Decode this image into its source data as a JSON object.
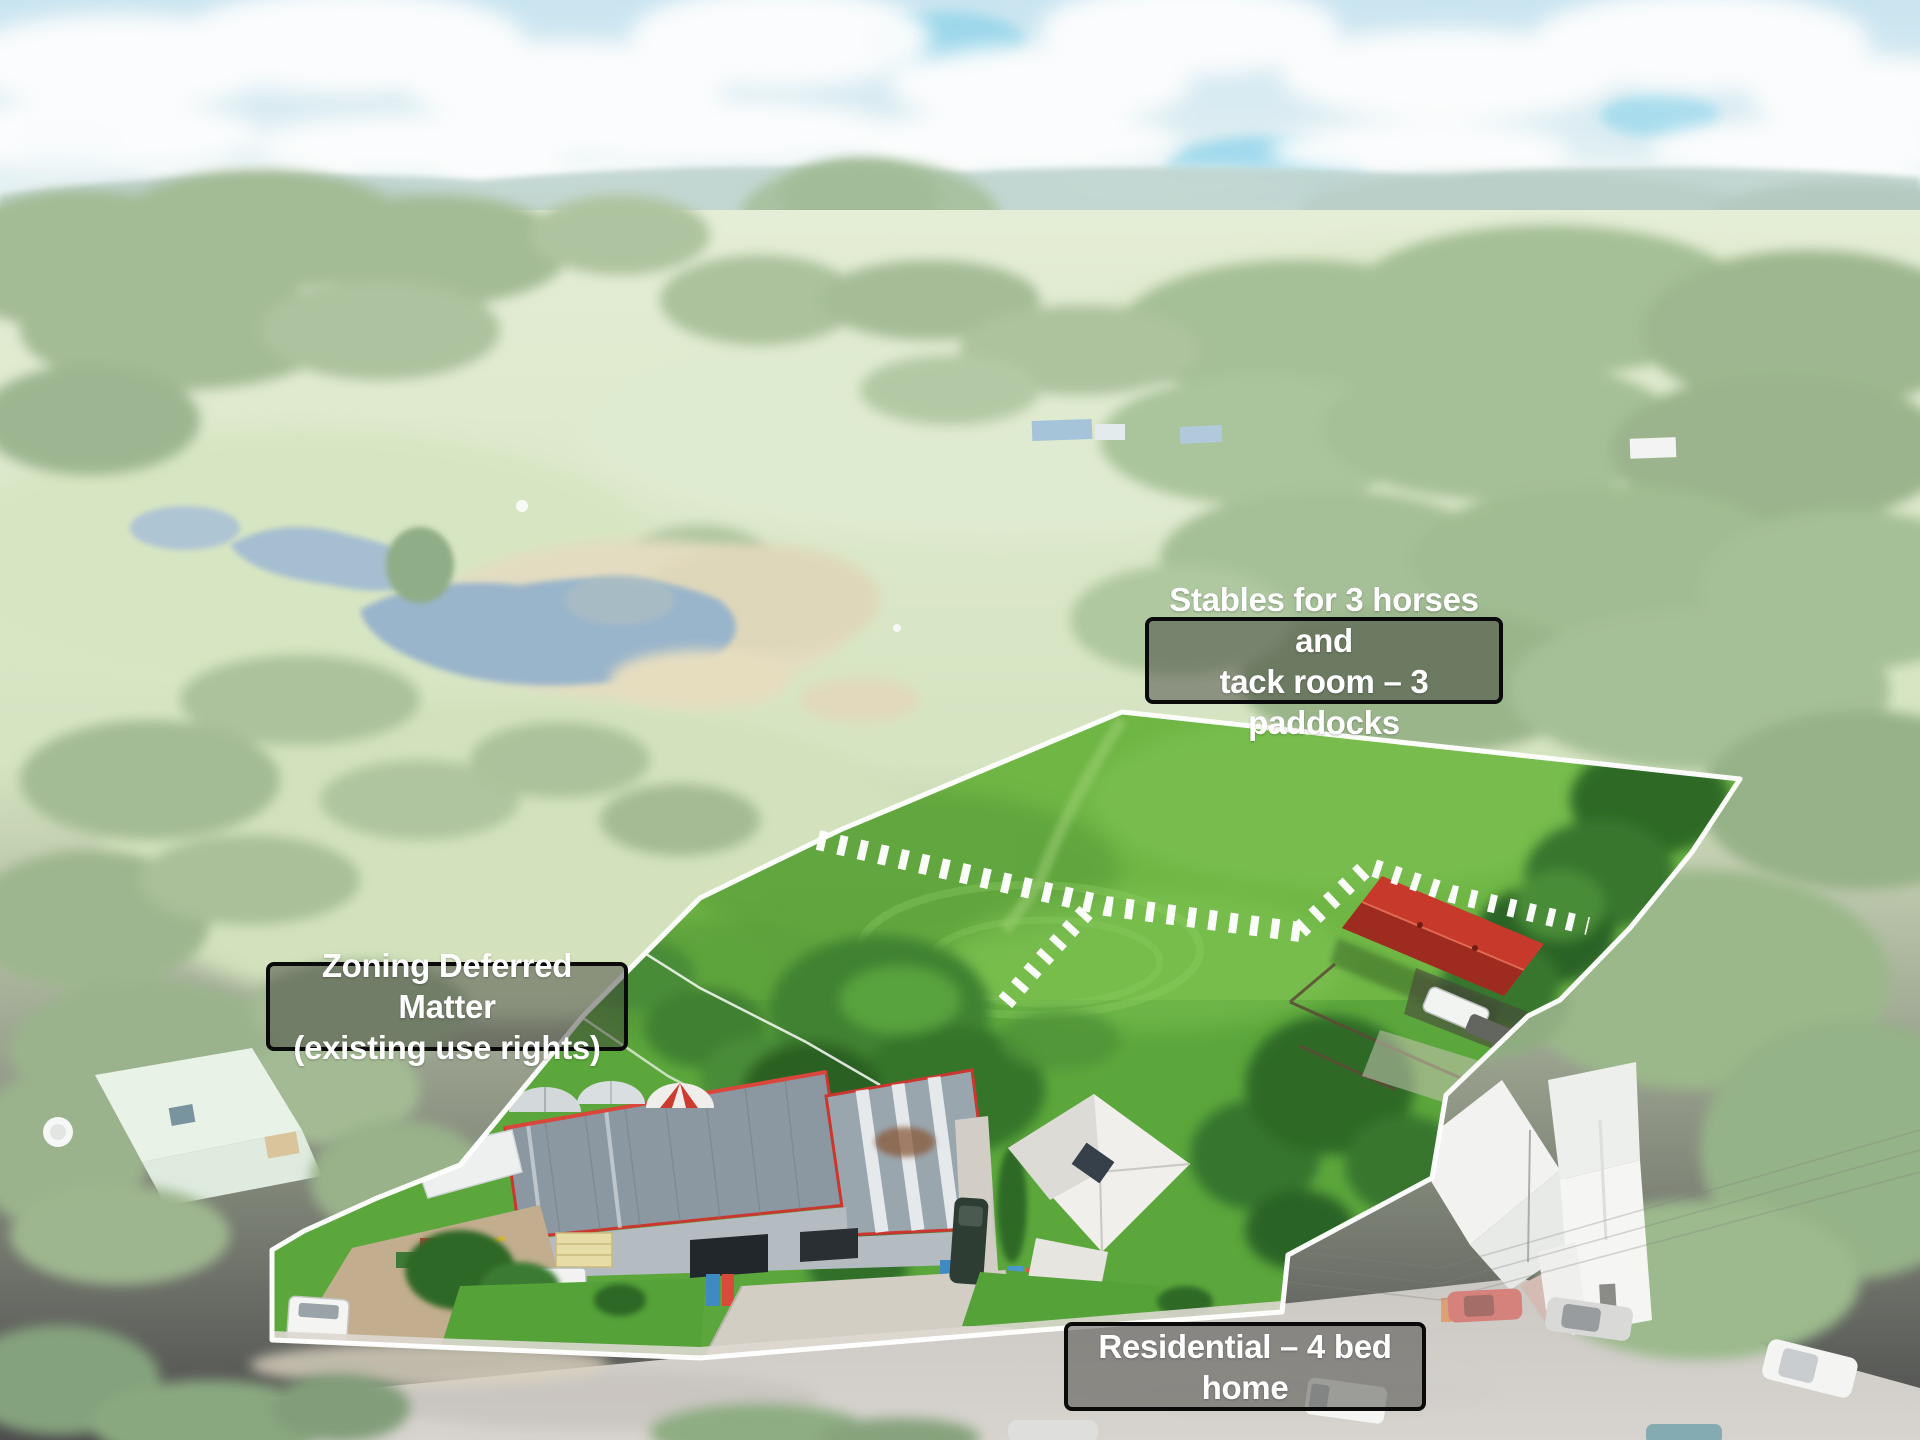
{
  "annotations": {
    "stables": {
      "lines": [
        "Stables for 3 horses and",
        "tack room – 3 paddocks"
      ]
    },
    "zoning": {
      "lines": [
        "Zoning Deferred Matter",
        "(existing use rights)"
      ]
    },
    "residential": {
      "lines": [
        "Residential – 4 bed home"
      ]
    }
  },
  "colors": {
    "boundary": "#ffffff",
    "paddock_green": "#6fb645",
    "stable_roof_red": "#c6392b",
    "shed_roof_gray": "#8b98a2",
    "house_roof_white": "#f0efeb",
    "annotation_box_bg": "#3a3a36",
    "annotation_border": "#0a0a0a",
    "annotation_text": "#ffffff"
  }
}
